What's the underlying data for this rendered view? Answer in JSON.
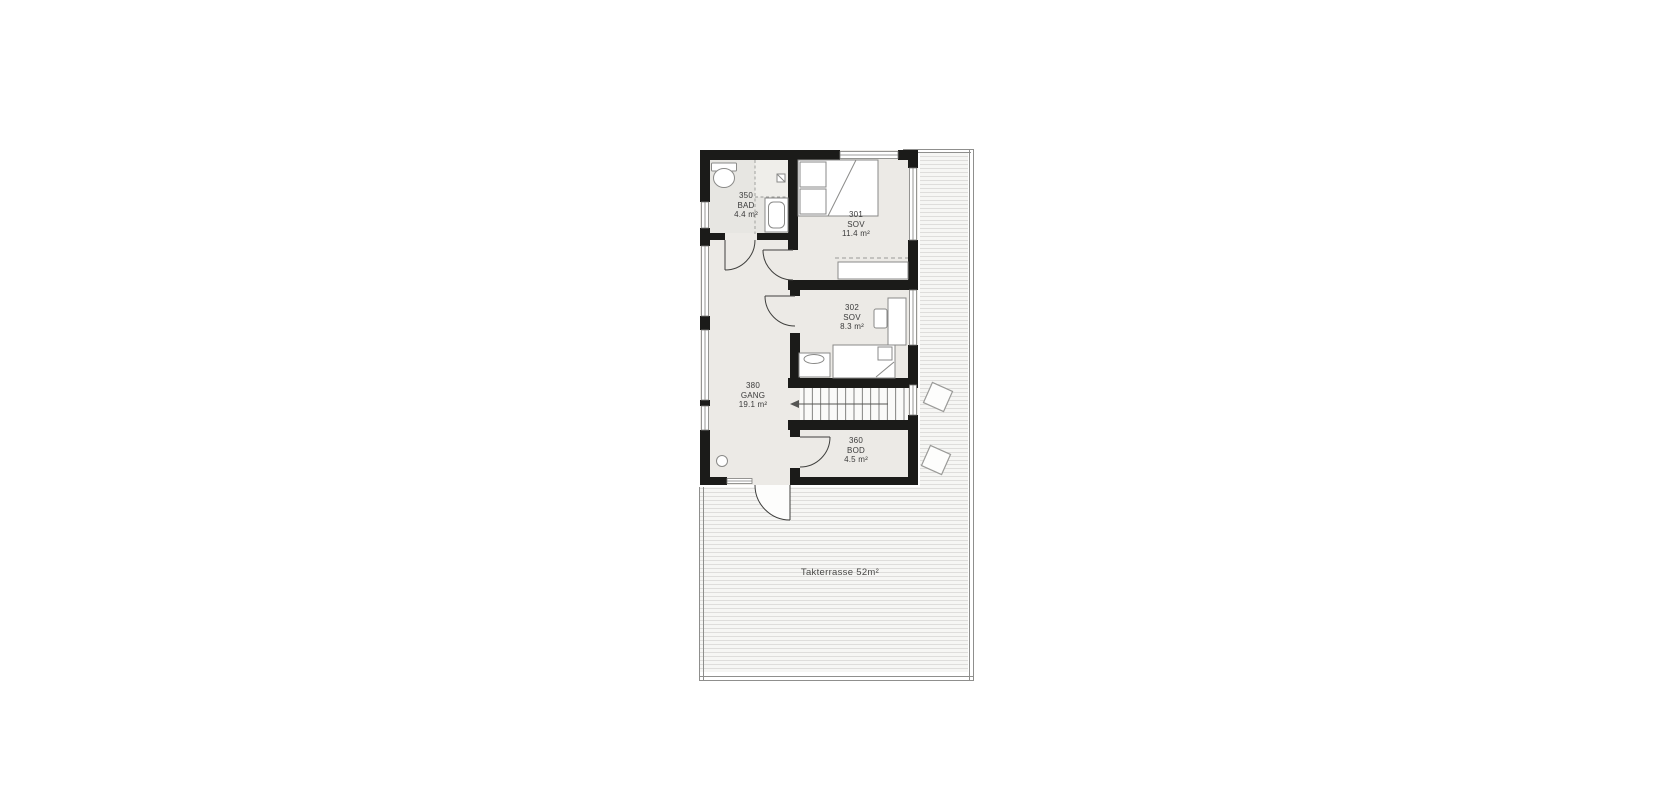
{
  "plan": {
    "title": "floor-plan",
    "rooms": [
      {
        "number": "350",
        "name": "BAD",
        "area": "4.4 m²"
      },
      {
        "number": "301",
        "name": "SOV",
        "area": "11.4 m²"
      },
      {
        "number": "302",
        "name": "SOV",
        "area": "8.3 m²"
      },
      {
        "number": "380",
        "name": "GANG",
        "area": "19.1 m²"
      },
      {
        "number": "360",
        "name": "BOD",
        "area": "4.5 m²"
      }
    ],
    "terrace_label": "Takterrasse 52m²",
    "symbols": [
      "toilet-icon",
      "sink-icon",
      "floor-drain-icon",
      "double-bed",
      "single-bed",
      "wardrobe",
      "desk",
      "chair",
      "dresser",
      "ceiling-lamp",
      "staircase",
      "stair-direction-arrow",
      "door-swing",
      "roof-window"
    ],
    "colors": {
      "wall": "#1b1b19",
      "room_floor": "#eceae6",
      "bath_floor": "#e7e6e2",
      "deck_background": "#f6f6f4",
      "deck_lines": "#dedddb",
      "outline": "#8f8f8d",
      "text": "#3a3a3a"
    }
  }
}
